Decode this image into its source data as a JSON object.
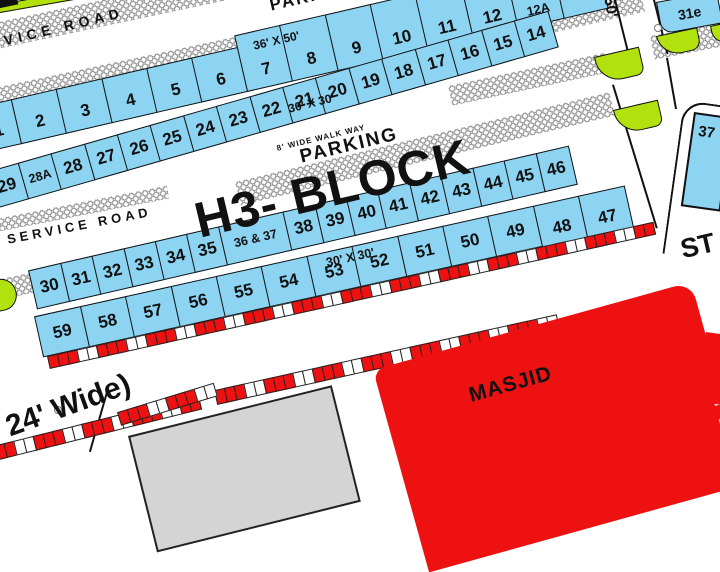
{
  "block_title": "H3- BLOCK",
  "labels": {
    "service_road_top": "SERVICE ROAD",
    "parking_top": "PARKING",
    "size_36x50": "36' X 50'",
    "size_30x30_upper": "30' X 30'",
    "size_30x30_lower": "30' X 30'",
    "walkway": "8' WIDE WALK WAY",
    "parking_mid": "PARKING",
    "service_road_mid": "SERVICE ROAD",
    "street_st": "ST",
    "street_width": "24' Wide)",
    "road_50": "50'",
    "masjid": "MASJID"
  },
  "plot_rows": [
    {
      "name": "row-1",
      "cells": [
        "1",
        "2",
        "3",
        "4",
        "5",
        "6",
        "7",
        "8",
        "9",
        "10",
        "11",
        "12",
        "12A",
        ""
      ]
    },
    {
      "name": "row-2",
      "cells": [
        "29",
        "28A",
        "28",
        "27",
        "26",
        "25",
        "24",
        "23",
        "22",
        "21",
        "20",
        "19",
        "18",
        "17",
        "16",
        "15",
        "14"
      ]
    },
    {
      "name": "row-3",
      "cells": [
        "30",
        "31",
        "32",
        "33",
        "34",
        "35",
        "36 & 37",
        "38",
        "39",
        "40",
        "41",
        "42",
        "43",
        "44",
        "45",
        "46"
      ]
    },
    {
      "name": "row-4",
      "cells": [
        "59",
        "58",
        "57",
        "56",
        "55",
        "54",
        "53",
        "52",
        "51",
        "50",
        "49",
        "48",
        "47"
      ]
    }
  ],
  "right_plots": {
    "corner_plot": "31e",
    "edge_plot": "37"
  },
  "colors": {
    "plot_fill": "#8dd4f2",
    "green": "#b2e20d",
    "red": "#ee1111",
    "building_gray": "#d4d4d4",
    "hatch": "#9a9a9a",
    "line": "#111111"
  }
}
